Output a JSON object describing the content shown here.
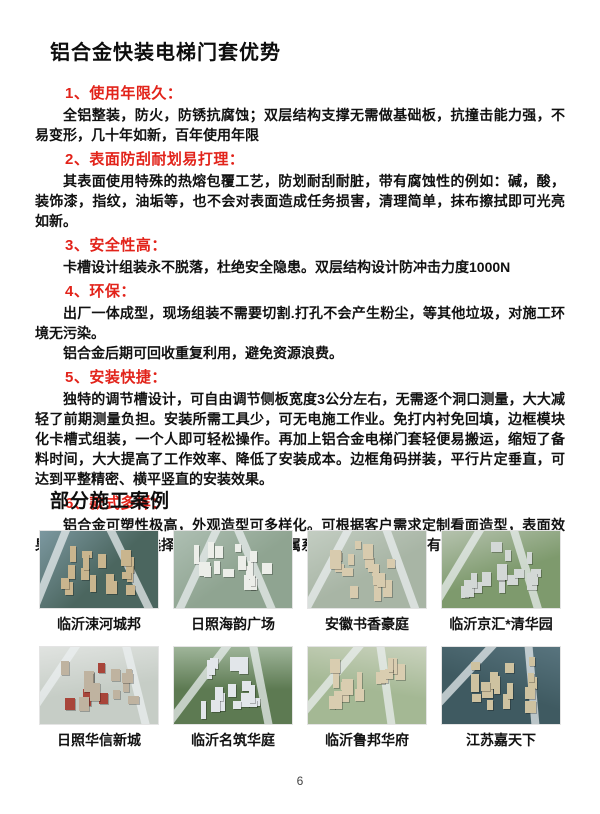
{
  "page": {
    "number": "6"
  },
  "colors": {
    "accent_red": "#e2231a",
    "text": "#1a1a1a"
  },
  "advantages": {
    "title": "铝合金快装电梯门套优势",
    "sections": [
      {
        "heading": "1、使用年限久：",
        "paragraphs": [
          "全铝整装，防火，防锈抗腐蚀；双层结构支撑无需做基础板，抗撞击能力强，不易变形，几十年如新，百年使用年限"
        ]
      },
      {
        "heading": "2、表面防刮耐划易打理：",
        "paragraphs": [
          "其表面使用特殊的热熔包覆工艺，防划耐刮耐脏，带有腐蚀性的例如：碱，酸，装饰漆，指纹，油垢等，也不会对表面造成任务损害，清理简单，抹布擦拭即可光亮如新。"
        ]
      },
      {
        "heading": "3、安全性高：",
        "paragraphs": [
          "卡槽设计组装永不脱落，杜绝安全隐患。双层结构设计防冲击力度1000N"
        ]
      },
      {
        "heading": "4、环保：",
        "paragraphs": [
          "出厂一体成型，现场组装不需要切割.打孔不会产生粉尘，等其他垃圾，对施工环境无污染。",
          "铝合金后期可回收重复利用，避免资源浪费。"
        ]
      },
      {
        "heading": "5、安装快捷：",
        "paragraphs": [
          "独特的调节槽设计，可自由调节侧板宽度3公分左右，无需逐个洞口测量，大大减轻了前期测量负担。安装所需工具少，可无电施工作业。免打内衬免回填，边框模块化卡槽式组装，一个人即可轻松操作。再加上铝合金电梯门套轻便易搬运，缩短了备料时间，大大提高了工作效率、降低了安装成本。边框角码拼装，平行片定垂直，可达到平整精密、横平竖直的安装效果。"
        ]
      },
      {
        "heading": "6、款式多样：",
        "paragraphs": [
          "铝合金可塑性极高，外观造型可多样化。可根据客户需求定制看面造型，表面效果有多种系列可供选择，大理石系列、金属系列、木纹系列，应有尽有。"
        ]
      }
    ]
  },
  "cases": {
    "title": "部分施工案例",
    "items": [
      {
        "caption": "临沂涑河城邦",
        "palette": {
          "far": "#7c98a0",
          "ground": "#4b665f",
          "building": "#c9b58e"
        }
      },
      {
        "caption": "日照海韵广场",
        "palette": {
          "far": "#aebfb3",
          "ground": "#8fa491",
          "building": "#eceee9"
        }
      },
      {
        "caption": "安徽书香豪庭",
        "palette": {
          "far": "#c3cdc2",
          "ground": "#a8b5a5",
          "building": "#d8cbae"
        }
      },
      {
        "caption": "临沂京汇*清华园",
        "palette": {
          "far": "#b5c2ae",
          "ground": "#7e9a6d",
          "building": "#d3d8d6"
        }
      },
      {
        "caption": "日照华信新城",
        "palette": {
          "far": "#e0e3e0",
          "ground": "#c6cdc6",
          "building": "#bfb3a0",
          "accent": "#a8453a"
        }
      },
      {
        "caption": "临沂名筑华庭",
        "palette": {
          "far": "#9fb59a",
          "ground": "#5d7a52",
          "building": "#e2e6ea"
        }
      },
      {
        "caption": "临沂鲁邦华府",
        "palette": {
          "far": "#c9d2bd",
          "ground": "#a4b894",
          "building": "#d9cdb0"
        }
      },
      {
        "caption": "江苏嘉天下",
        "palette": {
          "far": "#58747e",
          "ground": "#3f5a61",
          "building": "#cec2a0"
        }
      }
    ]
  }
}
